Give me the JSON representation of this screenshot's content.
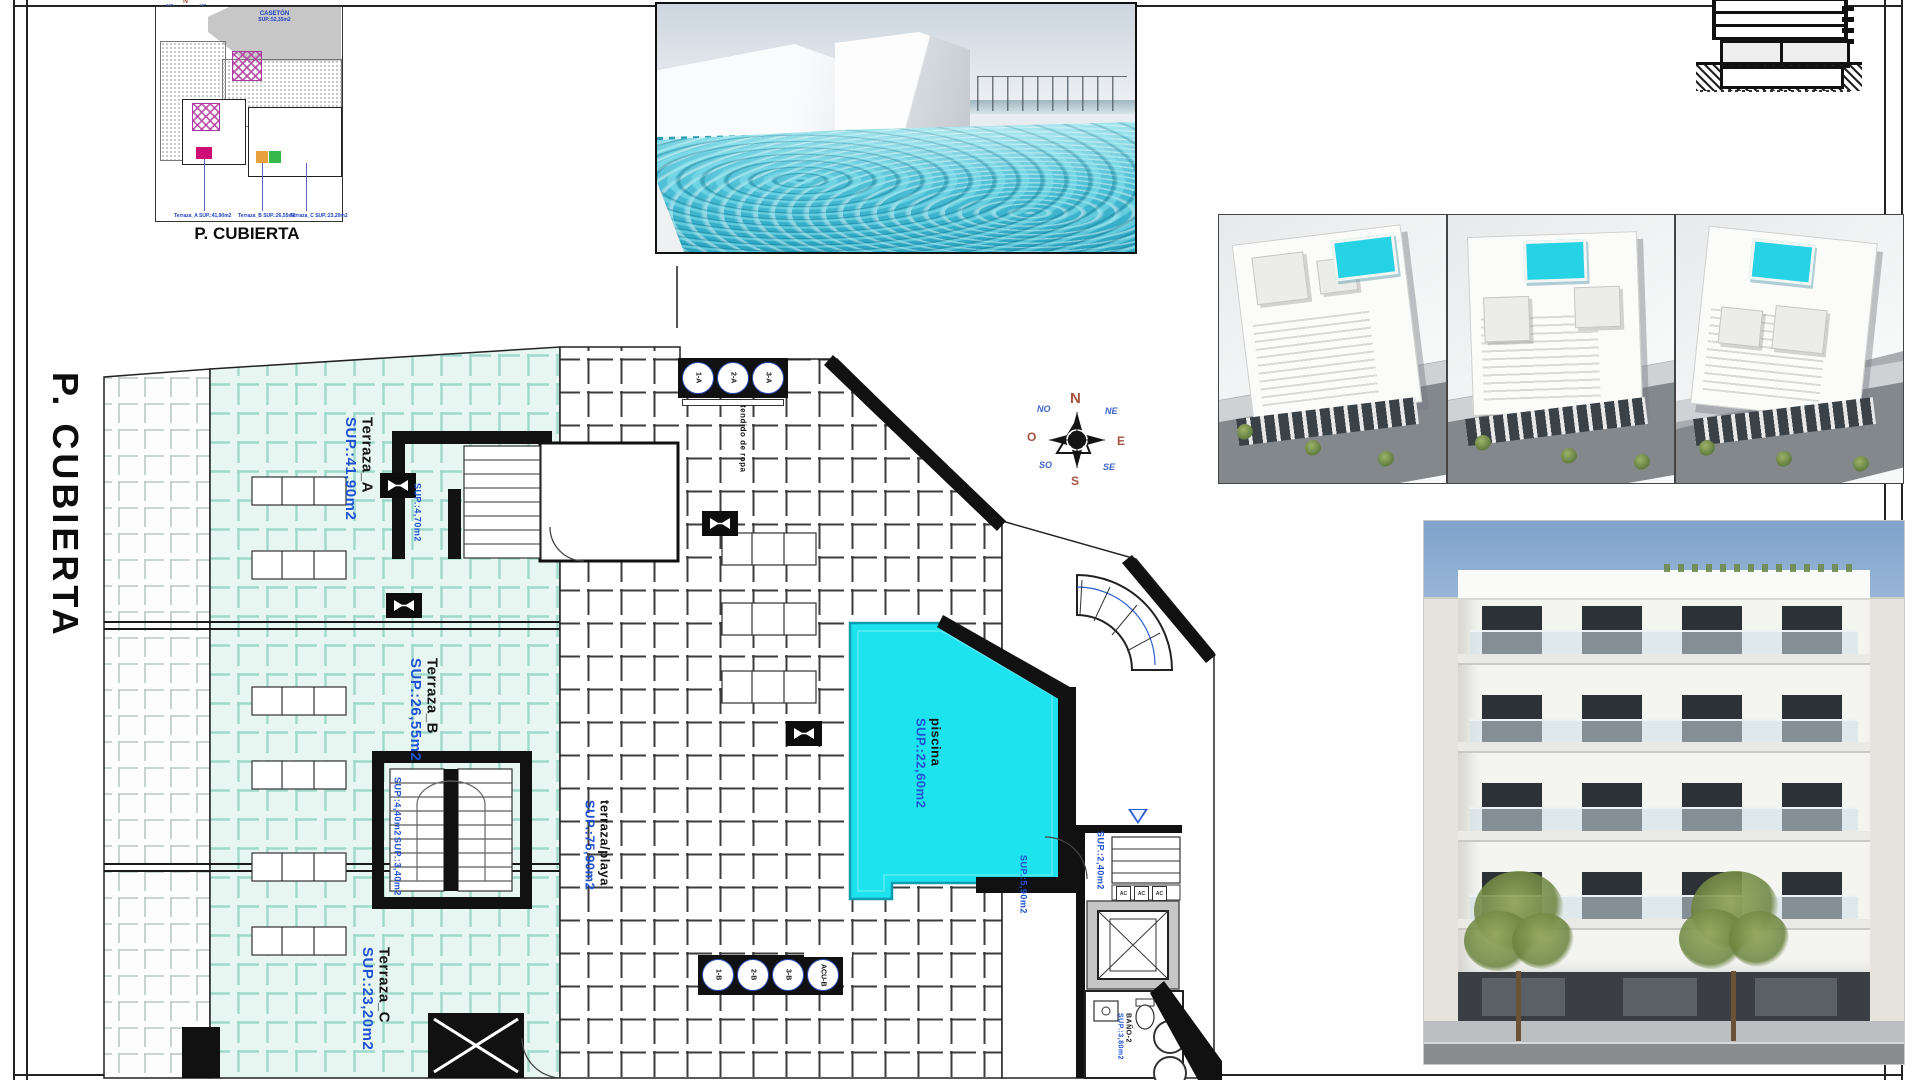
{
  "sheet": {
    "side_title": "P. CUBIERTA"
  },
  "site_plan": {
    "caption": "P. CUBIERTA",
    "roof_name": "CASETÓN",
    "roof_sup": "SUP.:52,35m2",
    "unit_labels": [
      "Terraza_A SUP.:41,90m2",
      "Terraza_B SUP.:26,55m2",
      "Terraza_C SUP.:23,20m2"
    ]
  },
  "compass": {
    "n": "N",
    "ne": "NE",
    "e": "E",
    "se": "SE",
    "s": "S",
    "so": "SO",
    "o": "O",
    "no": "NO"
  },
  "plan": {
    "terraza_a": {
      "name": "Terraza_A",
      "sup": "SUP.:41,90m2"
    },
    "terraza_b": {
      "name": "Terraza_B",
      "sup": "SUP.:26,55m2"
    },
    "terraza_c": {
      "name": "Terraza_C",
      "sup": "SUP.:23,20m2"
    },
    "terraza_playa": {
      "name": "terraza/playa",
      "sup": "SUP.:75,90m2"
    },
    "piscina": {
      "name": "piscina",
      "sup": "SUP.:22,60m2"
    },
    "bano": {
      "name": "BAÑO-2",
      "sup": "SUP.:3,80m2"
    },
    "sup_stair_top": "SUP.:4,70m2",
    "sup_stair_mid_a": "SUP.:4,40m2",
    "sup_stair_mid_b": "SUP.:3,40m2",
    "sup_stair_right": "SUP.:2,40m2",
    "sup_solarium": "SUP.:5,90m2",
    "tendido": "tendido de ropa",
    "ac": "AC",
    "tanks_top": [
      "1-A",
      "2-A",
      "3-A"
    ],
    "tanks_bottom": [
      "1-B",
      "2-B",
      "3-B",
      "ACU-B"
    ]
  },
  "colors": {
    "pool_cyan": "#1de3ef",
    "terrace_tile": "#e7f6f1",
    "label_blue": "#2053d4",
    "hatch_magenta": "#a938a0"
  }
}
